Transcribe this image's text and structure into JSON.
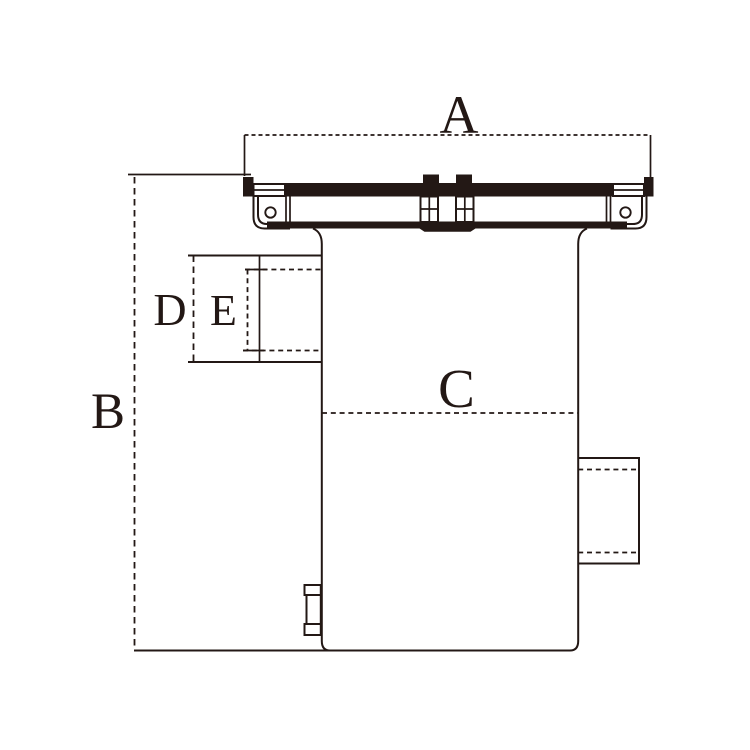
{
  "diagram": {
    "kind": "technical dimension drawing",
    "dimension_labels": [
      "A",
      "B",
      "C",
      "D",
      "E"
    ]
  },
  "labels": {
    "dim_a": "A",
    "dim_b": "B",
    "dim_c": "C",
    "dim_d": "D",
    "dim_e": "E"
  },
  "colors": {
    "line": "#231815",
    "background": "#ffffff"
  }
}
